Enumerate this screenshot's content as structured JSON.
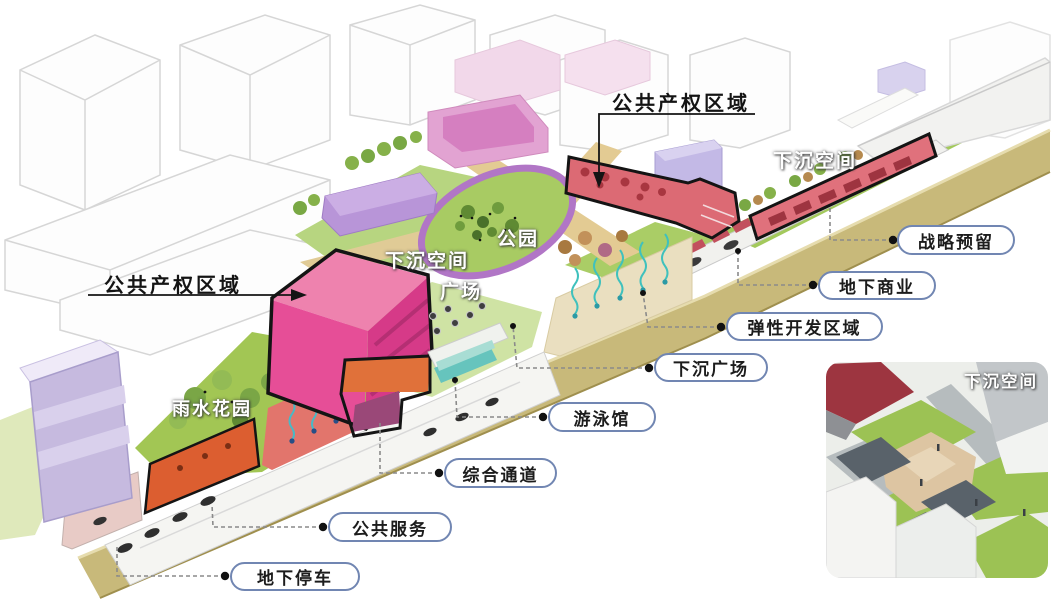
{
  "diagram": {
    "type": "urban-design-axonometric-diagram",
    "black_annotations": [
      {
        "id": "public-property-top",
        "text": "公共产权区域"
      },
      {
        "id": "public-property-left",
        "text": "公共产权区域"
      }
    ],
    "site_labels": [
      {
        "id": "sunken-space-right",
        "text": "下沉空间"
      },
      {
        "id": "park",
        "text": "公园"
      },
      {
        "id": "sunken-space-center",
        "text": "下沉空间"
      },
      {
        "id": "plaza",
        "text": "广场"
      },
      {
        "id": "rain-garden",
        "text": "雨水花园"
      }
    ],
    "callouts": [
      {
        "id": "strategic-reserve",
        "text": "战略预留"
      },
      {
        "id": "underground-commercial",
        "text": "地下商业"
      },
      {
        "id": "flexible-development-zone",
        "text": "弹性开发区域"
      },
      {
        "id": "sunken-plaza",
        "text": "下沉广场"
      },
      {
        "id": "swimming-hall",
        "text": "游泳馆"
      },
      {
        "id": "integrated-corridor",
        "text": "综合通道"
      },
      {
        "id": "public-service",
        "text": "公共服务"
      },
      {
        "id": "underground-parking",
        "text": "地下停车"
      }
    ],
    "inset": {
      "label": "下沉空间"
    },
    "colors": {
      "highlight_magenta": "#e64e97",
      "highlight_red": "#dc6a74",
      "highlight_orange": "#dc5e30",
      "callout_border": "#7186b2",
      "leader_line": "#8a8a8a",
      "annotation_black": "#141414",
      "lawn_green": "#a9cd62",
      "ground_tan": "#c8b97a",
      "water_teal": "#3fc1bd",
      "pool_teal": "#66c4bd",
      "lavender": "#c6badf",
      "park_ring_purple": "#b176c6"
    }
  }
}
